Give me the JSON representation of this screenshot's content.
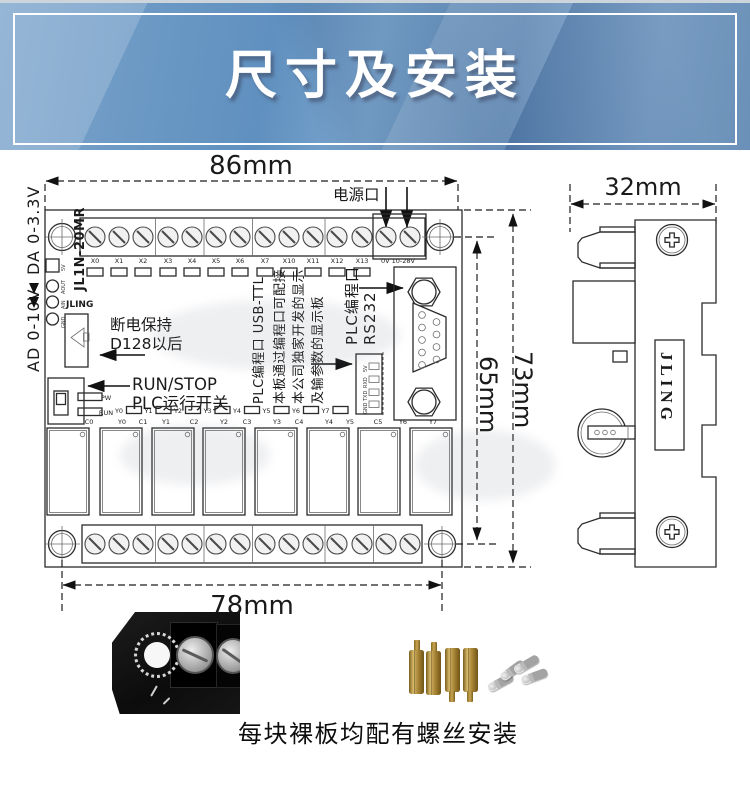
{
  "banner": {
    "title": "尺寸及安装"
  },
  "front_view": {
    "dim_top": "86mm",
    "dim_bottom": "78mm",
    "dim_right_outer": "73mm",
    "dim_right_inner": "65mm",
    "power_port_label": "电源口",
    "power_terminal_label": "0V 10-28V",
    "input_terminals": [
      "X0",
      "X1",
      "X2",
      "X3",
      "X4",
      "X5",
      "X6",
      "X7",
      "X10",
      "X11",
      "X12",
      "X13"
    ],
    "left_rail": {
      "analog_out": "DA 0-3.3V",
      "analog_in": "AD 0-10V",
      "model": "JL1N-20MR",
      "brand": "JLING",
      "pad_labels": [
        "5V",
        "AOUT",
        "AIN",
        "GND"
      ]
    },
    "retain_note": {
      "line1": "断电保持",
      "line2": "D128以后"
    },
    "run_switch": {
      "line1": "RUN/STOP",
      "line2": "PLC运行开关",
      "led_power": "PW",
      "led_run": "RUN"
    },
    "usb_note": {
      "col1": "PLC编程口 USB-TTL",
      "col2": "本板通过编程口可配接",
      "col3": "本公司独家开发的显示",
      "col4": "及输参数的显示板"
    },
    "rs232_note": {
      "line1": "PLC编程口",
      "line2": "RS232"
    },
    "ttl_pins": [
      "5V",
      "RXD",
      "TXD",
      "GND"
    ],
    "output_leds": [
      "Y0",
      "Y1",
      "Y2",
      "Y3",
      "Y4",
      "Y5",
      "Y6",
      "Y7"
    ],
    "output_terminals": [
      "C0",
      "Y0",
      "C1",
      "Y1",
      "C2",
      "Y2",
      "C3",
      "Y3",
      "C4",
      "Y4",
      "Y5",
      "C5",
      "Y6",
      "Y7"
    ]
  },
  "side_view": {
    "dim_top": "32mm",
    "brand": "JLING"
  },
  "footer": {
    "caption": "每块裸板均配有螺丝安装"
  },
  "colors": {
    "banner_blue": "#6090bf",
    "line": "#2b2b2b",
    "brass": "#b08d3e"
  }
}
